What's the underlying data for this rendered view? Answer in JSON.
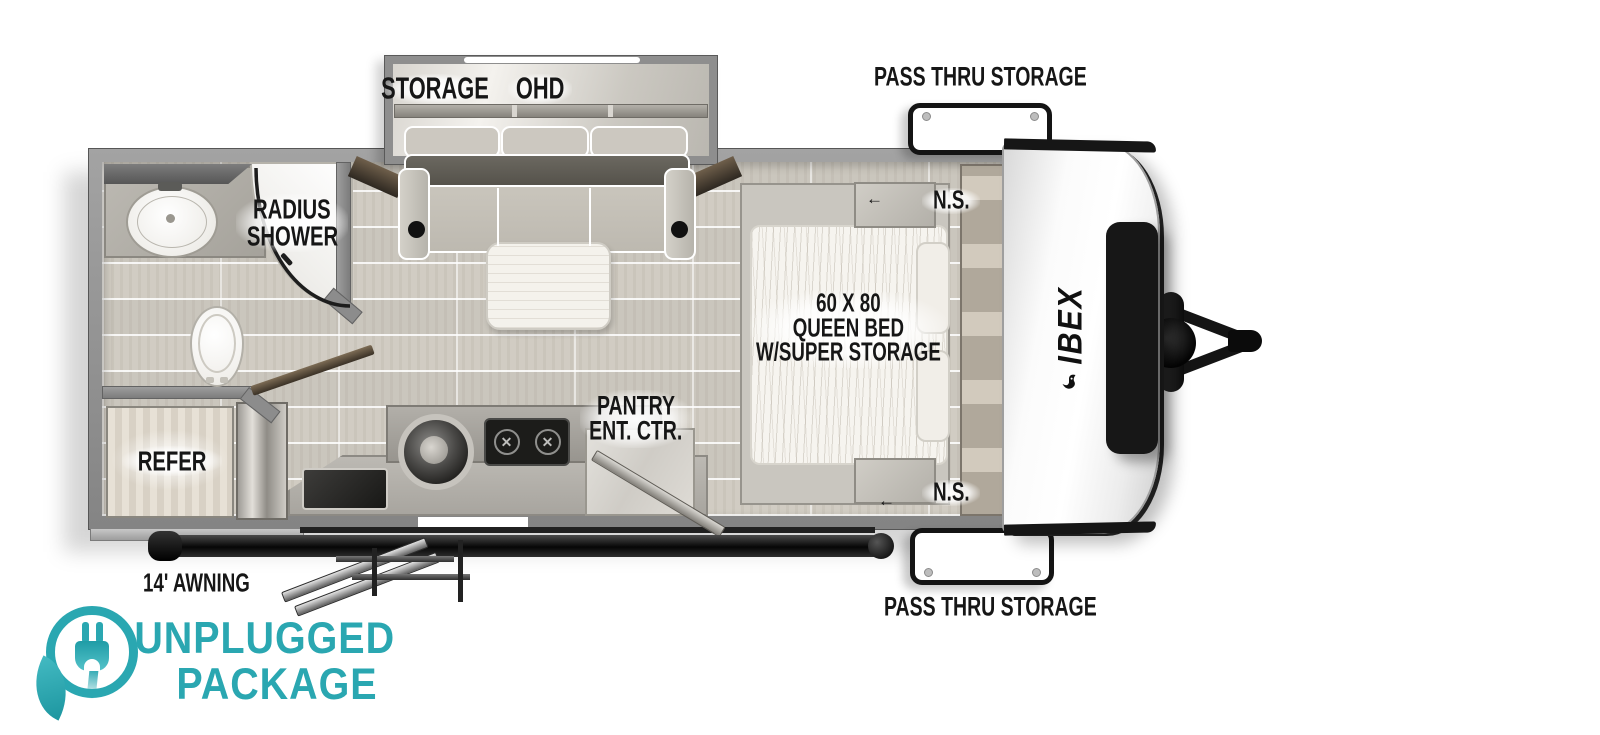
{
  "brand": {
    "logo_text": "IBEX"
  },
  "labels": {
    "storage": "STORAGE",
    "ohd": "OHD",
    "pass_thru_top": "PASS THRU STORAGE",
    "pass_thru_bottom": "PASS THRU STORAGE",
    "radius_shower": [
      "RADIUS",
      "SHOWER"
    ],
    "ns_top": "N.S.",
    "ns_bottom": "N.S.",
    "bed": [
      "60 X 80",
      "QUEEN BED",
      "W/SUPER STORAGE"
    ],
    "pantry": [
      "PANTRY",
      "ENT. CTR."
    ],
    "refer": "REFER",
    "awning": "14' AWNING"
  },
  "badge": {
    "line1": "UNPLUGGED",
    "line2": "PACKAGE",
    "color": "#2aa7b1"
  },
  "colors": {
    "accent_teal": "#2aa7b1",
    "wall_gray": "#8e8e8e",
    "floor_plank": "#d7d3ca",
    "label_text": "#161616",
    "cap_trim": "#161616"
  }
}
